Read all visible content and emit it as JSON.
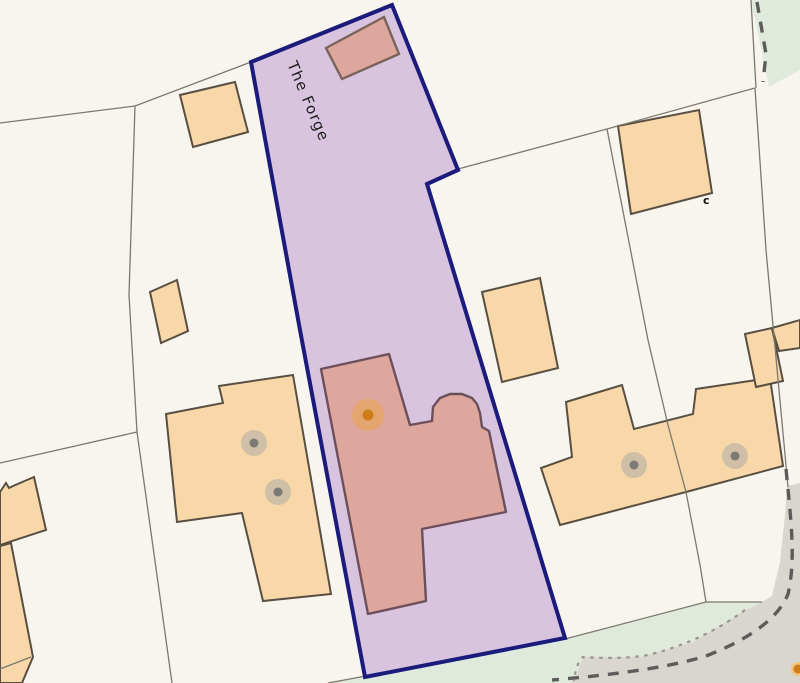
{
  "map": {
    "parcel_label": "The Forge",
    "corner_mark": "c"
  },
  "colors": {
    "bg": "#f8f5ee",
    "green": "#dfeadd",
    "road": "#d9d6cf",
    "parcel-fill": "#d8c4de",
    "parcel-stroke": "#1b1b7c",
    "building-fill": "#f8d7a9",
    "building-stroke": "#584f42",
    "inner-fill": "#dda79e",
    "inner-stroke": "#6d4f5c",
    "barn-stroke": "#7a635a",
    "line": "#7d786e",
    "dash": "#5c5c5a",
    "dots": "#98958b",
    "marker-halo": "#eba43e",
    "marker-core": "#cf7d18",
    "poi-outer": "#f1c479",
    "well-halo": "#aeaba5",
    "well-core": "#7c7a75",
    "text": "#1c1c1c",
    "mark": "#111111"
  }
}
